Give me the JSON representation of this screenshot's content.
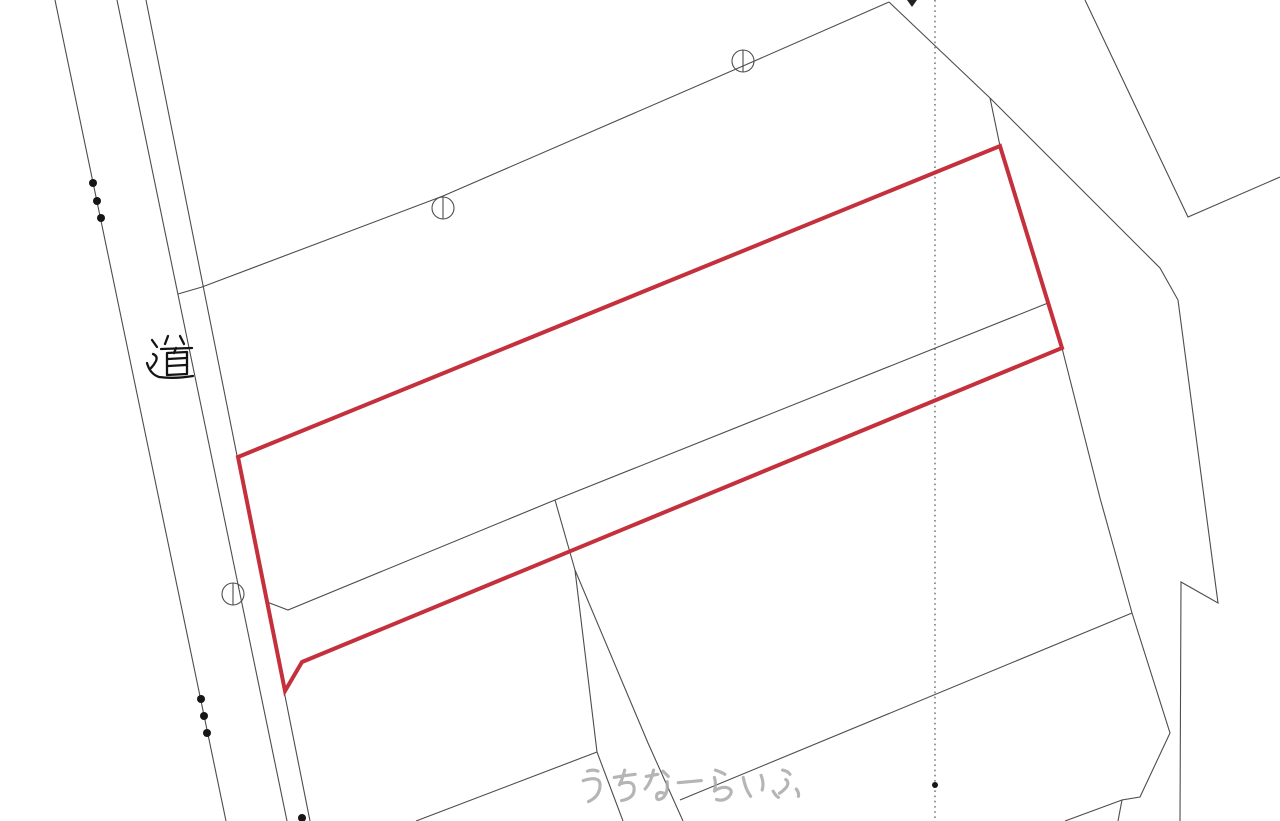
{
  "map": {
    "width": 1280,
    "height": 821,
    "background": "#ffffff",
    "line_color": "#4d4d4d",
    "highlight_color": "#c4303c",
    "road_label": {
      "text": "道",
      "x": 150,
      "y": 333,
      "font_size": 43
    },
    "watermark": {
      "text": "うちなーらいふ",
      "x": 578,
      "y": 768,
      "color": "#a9a9a9"
    },
    "highlight_parcel": {
      "stroke_width": 4,
      "points": [
        [
          238,
          457
        ],
        [
          1000,
          146
        ],
        [
          1062,
          348
        ],
        [
          302,
          662
        ],
        [
          285,
          691
        ]
      ]
    },
    "boundary_lines": [
      {
        "name": "road-west-edge",
        "points": [
          [
            55,
            0
          ],
          [
            226,
            821
          ]
        ]
      },
      {
        "name": "road-east-edge",
        "points": [
          [
            117,
            0
          ],
          [
            287,
            821
          ]
        ]
      },
      {
        "name": "roadside-parcel-edge",
        "points": [
          [
            146,
            0
          ],
          [
            310,
            821
          ]
        ]
      },
      {
        "name": "north-parcel-boundary",
        "points": [
          [
            178,
            294
          ],
          [
            202,
            287
          ],
          [
            443,
            196
          ],
          [
            743,
            66
          ],
          [
            889,
            2
          ]
        ]
      },
      {
        "name": "northeast-boundary",
        "points": [
          [
            889,
            2
          ],
          [
            990,
            98
          ],
          [
            1112,
            220
          ],
          [
            1160,
            268
          ],
          [
            1178,
            300
          ],
          [
            1218,
            603
          ],
          [
            1181,
            582
          ],
          [
            1180,
            821
          ]
        ]
      },
      {
        "name": "parcel-corner-connector",
        "points": [
          [
            990,
            98
          ],
          [
            1000,
            146
          ]
        ]
      },
      {
        "name": "inner-parcel-divider",
        "points": [
          [
            267,
            602
          ],
          [
            288,
            610
          ],
          [
            555,
            500
          ],
          [
            1048,
            303
          ]
        ]
      },
      {
        "name": "south-boundary-stem",
        "points": [
          [
            555,
            500
          ],
          [
            575,
            570
          ]
        ]
      },
      {
        "name": "south-strip-west-edge",
        "points": [
          [
            575,
            570
          ],
          [
            597,
            752
          ],
          [
            623,
            821
          ]
        ]
      },
      {
        "name": "south-strip-east-edge",
        "points": [
          [
            575,
            570
          ],
          [
            648,
            743
          ],
          [
            683,
            821
          ]
        ]
      },
      {
        "name": "southwest-diagonal-boundary",
        "points": [
          [
            416,
            821
          ],
          [
            597,
            752
          ]
        ]
      },
      {
        "name": "southeast-diagonal-boundary",
        "points": [
          [
            680,
            800
          ],
          [
            1132,
            613
          ]
        ]
      },
      {
        "name": "east-parcel-edge",
        "points": [
          [
            1062,
            348
          ],
          [
            1100,
            498
          ],
          [
            1132,
            613
          ]
        ]
      },
      {
        "name": "southeast-parcel-edge",
        "points": [
          [
            1132,
            613
          ],
          [
            1170,
            733
          ],
          [
            1140,
            797
          ],
          [
            1122,
            800
          ],
          [
            1118,
            821
          ]
        ]
      },
      {
        "name": "southeast-parcel-fork",
        "points": [
          [
            1122,
            800
          ],
          [
            1065,
            821
          ]
        ]
      },
      {
        "name": "northeast-notch-boundary",
        "points": [
          [
            1085,
            0
          ],
          [
            1188,
            217
          ],
          [
            1280,
            177
          ]
        ]
      }
    ],
    "dotted_line": {
      "color": "#555555",
      "points": [
        [
          935,
          0
        ],
        [
          935,
          820
        ]
      ]
    },
    "circle_markers": [
      {
        "cx": 443,
        "cy": 208,
        "r": 11
      },
      {
        "cx": 743,
        "cy": 61,
        "r": 11
      },
      {
        "cx": 233,
        "cy": 594,
        "r": 11
      }
    ],
    "point_markers": [
      {
        "cx": 93,
        "cy": 183,
        "r": 4
      },
      {
        "cx": 97,
        "cy": 201,
        "r": 4
      },
      {
        "cx": 101,
        "cy": 218,
        "r": 4
      },
      {
        "cx": 201,
        "cy": 699,
        "r": 4
      },
      {
        "cx": 204,
        "cy": 716,
        "r": 4
      },
      {
        "cx": 207,
        "cy": 733,
        "r": 4
      },
      {
        "cx": 302,
        "cy": 818,
        "r": 4
      },
      {
        "cx": 935,
        "cy": 785,
        "r": 3
      }
    ],
    "edge_tick": {
      "points": [
        [
          907,
          0
        ],
        [
          917,
          0
        ],
        [
          912,
          7
        ]
      ]
    }
  }
}
